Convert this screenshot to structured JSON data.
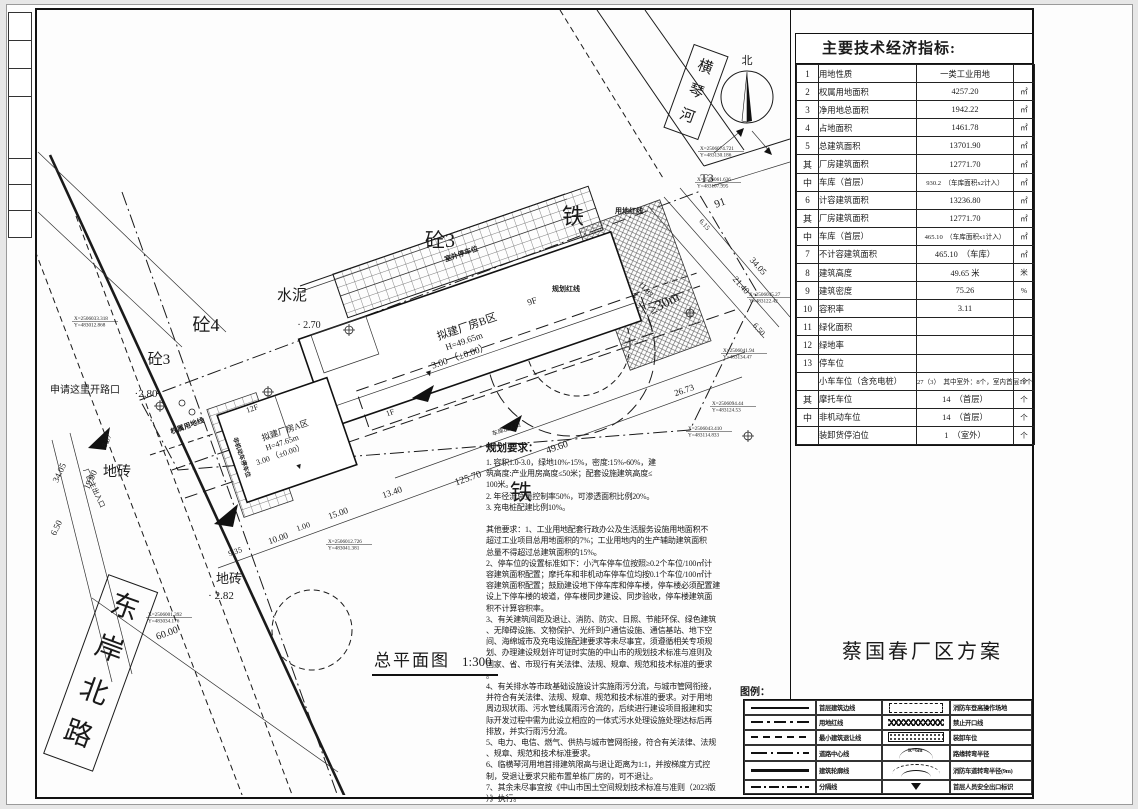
{
  "project": {
    "title": "蔡国春厂区方案"
  },
  "plan": {
    "title": "总平面图",
    "scale": "1:300"
  },
  "indicators": {
    "title": "主要技术经济指标:",
    "rows": [
      {
        "num": "1",
        "label": "用地性质",
        "value": "一类工业用地",
        "unit": ""
      },
      {
        "num": "2",
        "label": "权属用地面积",
        "value": "4257.20",
        "unit": "㎡"
      },
      {
        "num": "3",
        "label": "净用地总面积",
        "value": "1942.22",
        "unit": "㎡"
      },
      {
        "num": "4",
        "label": "占地面积",
        "value": "1461.78",
        "unit": "㎡"
      },
      {
        "num": "5",
        "label": "总建筑面积",
        "value": "13701.90",
        "unit": "㎡"
      },
      {
        "num": "其",
        "label": "厂房建筑面积",
        "value": "12771.70",
        "unit": "㎡"
      },
      {
        "num": "中",
        "label": "车库（首层）",
        "value": "930.2　（车库面积x2计入）",
        "unit": "㎡",
        "small": true
      },
      {
        "num": "6",
        "label": "计容建筑面积",
        "value": "13236.80",
        "unit": "㎡"
      },
      {
        "num": "其",
        "label": "厂房建筑面积",
        "value": "12771.70",
        "unit": "㎡"
      },
      {
        "num": "中",
        "label": "车库（首层）",
        "value": "465.10　（车库面积x1计入）",
        "unit": "㎡",
        "small": true
      },
      {
        "num": "7",
        "label": "不计容建筑面积",
        "value": "465.10　（车库）",
        "unit": "㎡"
      },
      {
        "num": "8",
        "label": "建筑高度",
        "value": "49.65 米",
        "unit": "米"
      },
      {
        "num": "9",
        "label": "建筑密度",
        "value": "75.26",
        "unit": "%"
      },
      {
        "num": "10",
        "label": "容积率",
        "value": "3.11",
        "unit": ""
      },
      {
        "num": "11",
        "label": "绿化面积",
        "value": "",
        "unit": ""
      },
      {
        "num": "12",
        "label": "绿地率",
        "value": "",
        "unit": ""
      },
      {
        "num": "13",
        "label": "停车位",
        "value": "",
        "unit": ""
      },
      {
        "num": "",
        "label": "小车车位（含充电桩）",
        "value": "27（3）　其中室外：8个，室内首层19个",
        "unit": "个",
        "small": true
      },
      {
        "num": "其",
        "label": "摩托车位",
        "value": "14　（首层）",
        "unit": "个"
      },
      {
        "num": "中",
        "label": "非机动车位",
        "value": "14　（首层）",
        "unit": "个"
      },
      {
        "num": "",
        "label": "装卸货停泊位",
        "value": "1　（室外）",
        "unit": "个"
      }
    ]
  },
  "legend": {
    "title": "图例：",
    "left": [
      {
        "symbol": "s-line",
        "label": "首层建筑边线"
      },
      {
        "symbol": "s-dashdot",
        "label": "用地红线"
      },
      {
        "symbol": "s-dash",
        "label": "最小建筑退让线"
      },
      {
        "symbol": "s-center",
        "label": "道路中心线"
      },
      {
        "symbol": "s-thick",
        "label": "建筑轮廓线"
      },
      {
        "symbol": "s-divider",
        "label": "分隔线"
      }
    ],
    "right": [
      {
        "symbol": "s-drect",
        "label": "消防车登高操作场地"
      },
      {
        "symbol": "s-zigzag",
        "label": "禁止开口线"
      },
      {
        "symbol": "s-hatch",
        "label": "装卸车位"
      },
      {
        "symbol": "s-arc",
        "label": "路缘转弯半径",
        "sym_text": "R=6m"
      },
      {
        "symbol": "s-arc2",
        "label": "消防车道转弯半径(9m)"
      },
      {
        "symbol": "s-tri",
        "label": "首层人员安全出口标识"
      }
    ]
  },
  "notes": {
    "title": "规划要求：",
    "lines": [
      "1. 容积1.0-3.0，绿地10%-15%，密度:15%-60%，建",
      "筑高度:产业用房高度≤50米；配套设施建筑高度≤",
      "100米。",
      "2. 年径流总量控制率50%，可渗透面积比例20%。",
      "3. 充电桩配建比例10%。",
      "",
      "其他要求：1、工业用地配套行政办公及生活服务设施用地面积不",
      "超过工业项目总用地面积的7%；工业用地内的生产辅助建筑面积",
      "总量不得超过总建筑面积的15%。",
      "2、停车位的设置标准如下：小汽车停车位按照≥0.2个车位/100㎡计",
      "容建筑面积配置；摩托车和非机动车停车位均按0.1个车位/100㎡计",
      "容建筑面积配置；鼓励建设地下停车库和停车楼，停车楼必须配置建",
      "设上下停车楼的坡道，停车楼同步建设、同步验收，停车楼建筑面",
      "积不计算容积率。",
      "3、有关建筑间距及退让、消防、防灾、日照、节能环保、绿色建筑",
      "、无障碍设施、文物保护、光纤到户通信设施、通信基站、地下空",
      "间、海绵城市及充电设施配建要求等未尽事宜，须遵循相关专项规",
      "划、办理建设规划许可证时实施的中山市的规划技术标准与准则及",
      "国家、省、市现行有关法律、法规、规章、规范和技术标准的要求",
      "。",
      "4、有关排水等市政基础设施设计实施雨污分流，与城市管网衔接，",
      "并符合有关法律、法规、规章、规范和技术标准的要求。对于用地",
      "周边现状雨、污水管线属雨污合流的，后续进行建设项目报建和实",
      "际开发过程中需为此设立相应的一体式污水处理设施处理达标后再",
      "排放，并实行雨污分流。",
      "5、电力、电信、燃气、供热与城市管网衔接，符合有关法律、法规",
      "、规章、规范和技术标准要求。",
      "6、临横琴河用地首排建筑限高与退让距离为1:1，并按梯度方式控",
      "制，受退让要求只能布置单栋厂房的，可不退让。",
      "7、其余未尽事宜按《中山市国土空间规划技术标准与准则（2023版",
      "）》执行。"
    ]
  },
  "drawing": {
    "north_label": "北",
    "river_name": "横琴河",
    "road_name": "东岸北路",
    "labels": [
      {
        "t": "砼3",
        "x": 440,
        "y": 247,
        "s": 20
      },
      {
        "t": "砼4",
        "x": 206,
        "y": 331,
        "s": 18
      },
      {
        "t": "砼3",
        "x": 159,
        "y": 364,
        "s": 15
      },
      {
        "t": "水泥",
        "x": 292,
        "y": 300,
        "s": 15
      },
      {
        "t": "地砖",
        "x": 117,
        "y": 476,
        "s": 14
      },
      {
        "t": "地砖",
        "x": 229,
        "y": 583,
        "s": 13
      },
      {
        "t": "铁",
        "x": 573,
        "y": 224,
        "s": 22
      },
      {
        "t": "铁",
        "x": 521,
        "y": 500,
        "s": 22
      },
      {
        "t": "T3",
        "x": 707,
        "y": 182,
        "s": 12
      },
      {
        "t": "91",
        "x": 721,
        "y": 206,
        "s": 11,
        "r": -20
      },
      {
        "t": "· 2.70",
        "x": 309,
        "y": 328,
        "s": 10
      },
      {
        "t": "·2.80",
        "x": 146,
        "y": 397,
        "s": 11
      },
      {
        "t": "· 2.82",
        "x": 221,
        "y": 599,
        "s": 11
      },
      {
        "t": "申请这里开路口",
        "x": 85,
        "y": 393,
        "s": 10
      },
      {
        "t": "北",
        "x": 747,
        "y": 64,
        "s": 11
      },
      {
        "t": "拟建厂房B区",
        "x": 468,
        "y": 330,
        "s": 11,
        "r": -19
      },
      {
        "t": "H=49.65m",
        "x": 465,
        "y": 344,
        "s": 9,
        "r": -19
      },
      {
        "t": "3.00 （±0.00）",
        "x": 461,
        "y": 359,
        "s": 9.5,
        "r": -19
      },
      {
        "t": "▼",
        "x": 430,
        "y": 376,
        "s": 9,
        "r": -19
      },
      {
        "t": "9F",
        "x": 533,
        "y": 304,
        "s": 9,
        "r": -19
      },
      {
        "t": "1F",
        "x": 391,
        "y": 415,
        "s": 8,
        "r": -19
      },
      {
        "t": "拟建厂房A区",
        "x": 286,
        "y": 433,
        "s": 8.5,
        "r": -19
      },
      {
        "t": "H=47.65m",
        "x": 283,
        "y": 445,
        "s": 8,
        "r": -19
      },
      {
        "t": "3.00 （±0.00）",
        "x": 281,
        "y": 457,
        "s": 8,
        "r": -19
      },
      {
        "t": "▼",
        "x": 300,
        "y": 469,
        "s": 8,
        "r": -19
      },
      {
        "t": "12F",
        "x": 253,
        "y": 411,
        "s": 8,
        "r": -19
      },
      {
        "t": "用地红线",
        "x": 629,
        "y": 213,
        "s": 7,
        "b": 1
      },
      {
        "t": "规划红线",
        "x": 566,
        "y": 291,
        "s": 7,
        "b": 1
      },
      {
        "t": "权属用地线",
        "x": 188,
        "y": 428,
        "s": 7,
        "r": -20,
        "b": 1
      },
      {
        "t": "室外停车位",
        "x": 462,
        "y": 256,
        "s": 7,
        "r": -19,
        "b": 1
      },
      {
        "t": "非机动车停车位",
        "x": 240,
        "y": 458,
        "s": 6,
        "r": 71,
        "b": 1
      },
      {
        "t": "车库出入口",
        "x": 507,
        "y": 431,
        "s": 6,
        "r": -19
      },
      {
        "t": "厂区主出入口",
        "x": 92,
        "y": 489,
        "s": 7,
        "r": 65
      },
      {
        "t": "≥30m",
        "x": 666,
        "y": 307,
        "s": 14,
        "r": -28
      },
      {
        "t": "49.60",
        "x": 558,
        "y": 450,
        "s": 10,
        "r": -19
      },
      {
        "t": "125.70",
        "x": 469,
        "y": 481,
        "s": 10,
        "r": -19
      },
      {
        "t": "13.40",
        "x": 393,
        "y": 495,
        "s": 9,
        "r": -19
      },
      {
        "t": "15.00",
        "x": 339,
        "y": 516,
        "s": 9,
        "r": -19
      },
      {
        "t": "1.00",
        "x": 304,
        "y": 529,
        "s": 8,
        "r": -19
      },
      {
        "t": "10.00",
        "x": 279,
        "y": 541,
        "s": 9,
        "r": -19
      },
      {
        "t": "9.35",
        "x": 236,
        "y": 554,
        "s": 8,
        "r": -19
      },
      {
        "t": "26.73",
        "x": 685,
        "y": 393,
        "s": 9,
        "r": -19
      },
      {
        "t": "60.00",
        "x": 168,
        "y": 636,
        "s": 10,
        "r": -20
      },
      {
        "t": "34.05",
        "x": 62,
        "y": 474,
        "s": 9,
        "r": -65
      },
      {
        "t": "19.90",
        "x": 93,
        "y": 481,
        "s": 9,
        "r": -65
      },
      {
        "t": "6.50",
        "x": 59,
        "y": 529,
        "s": 9,
        "r": -65
      },
      {
        "t": "8.07",
        "x": 109,
        "y": 442,
        "s": 8,
        "r": -65
      },
      {
        "t": "34.05",
        "x": 756,
        "y": 268,
        "s": 9,
        "r": 48
      },
      {
        "t": "21.40",
        "x": 739,
        "y": 287,
        "s": 9,
        "r": 48
      },
      {
        "t": "11.83",
        "x": 644,
        "y": 291,
        "s": 8,
        "r": 48
      },
      {
        "t": "6.50",
        "x": 757,
        "y": 331,
        "s": 8,
        "r": 48
      },
      {
        "t": "6.15",
        "x": 703,
        "y": 226,
        "s": 7,
        "r": 48
      }
    ],
    "coords": [
      {
        "x": 700,
        "y": 150,
        "lines": [
          "X=2506074.721",
          "Y=483130.186"
        ]
      },
      {
        "x": 697,
        "y": 181,
        "lines": [
          "X=2506061.636",
          "Y=483107.995"
        ]
      },
      {
        "x": 749,
        "y": 296,
        "lines": [
          "X=2506045.27",
          "Y=483122.42"
        ]
      },
      {
        "x": 723,
        "y": 352,
        "lines": [
          "X=2506041.94",
          "Y=483134.47"
        ]
      },
      {
        "x": 712,
        "y": 405,
        "lines": [
          "X=2506094.44",
          "Y=483124.53"
        ]
      },
      {
        "x": 688,
        "y": 430,
        "lines": [
          "X=2506043.410",
          "Y=483114.833"
        ]
      },
      {
        "x": 74,
        "y": 320,
        "lines": [
          "X=2506033.318",
          "Y=483012.868"
        ]
      },
      {
        "x": 328,
        "y": 543,
        "lines": [
          "X=2506012.726",
          "Y=483041.381"
        ]
      },
      {
        "x": 148,
        "y": 616,
        "lines": [
          "X=2506001.392",
          "Y=483034.176"
        ]
      }
    ]
  }
}
